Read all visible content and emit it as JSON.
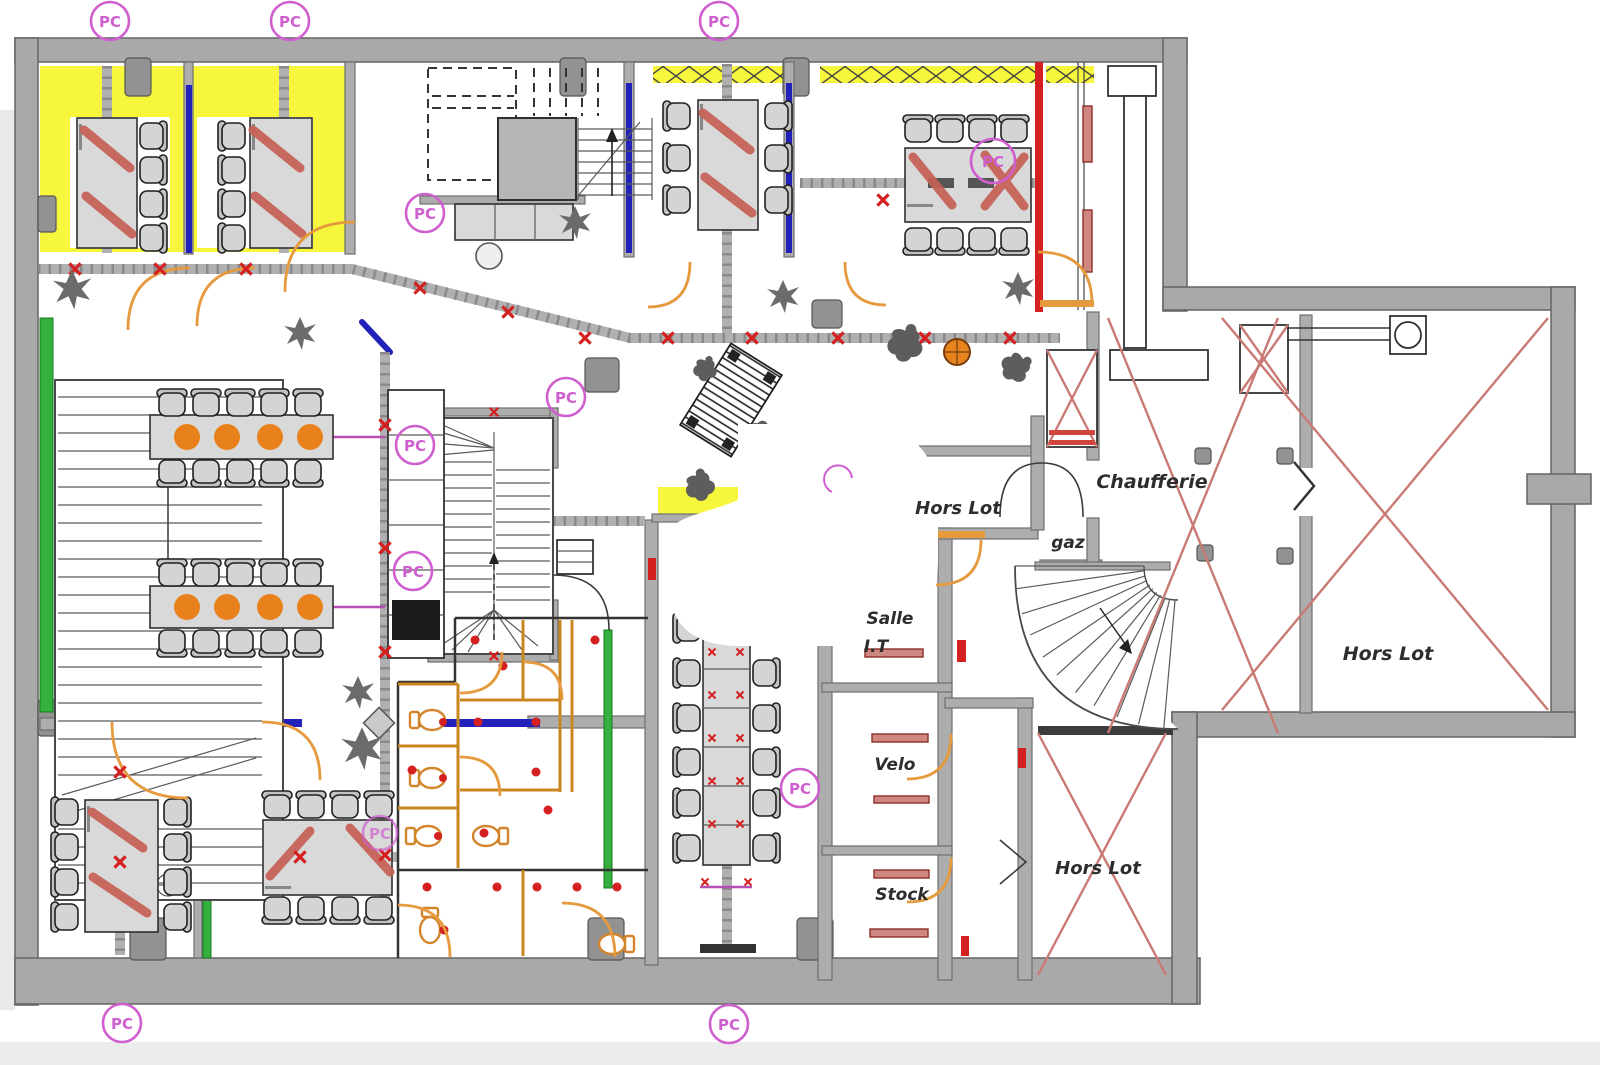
{
  "drawing": {
    "type": "architectural-floor-plan",
    "pc_marker_label": "PC",
    "room_labels": {
      "chaufferie": "Chaufferie",
      "gaz": "gaz",
      "hors_lot_lobby": "Hors Lot",
      "hors_lot_right_wing": "Hors Lot",
      "hors_lot_lower": "Hors Lot",
      "salle_it_line1": "Salle",
      "salle_it_line2": "I.T",
      "velo": "Velo",
      "stock": "Stock"
    },
    "colors": {
      "wall": "#a9a9a9",
      "wall_outline": "#646464",
      "highlight_yellow": "#f6f63c",
      "accent_red": "#d42020",
      "cross_red": "#c65f54",
      "room_x_red": "#c97a74",
      "door_orange": "#e69a3e",
      "accent_blue": "#2222bb",
      "accent_green": "#33b13c",
      "pc_magenta": "#cf5fcf",
      "furniture_gray": "#d9d9d9",
      "furniture_outline": "#2f2f2f",
      "seat_orange": "#e8811c",
      "bar_rose": "#cf8781",
      "rail_gray": "#b0b0b0",
      "stair_line": "#5a5a5a",
      "plant_gray": "#6b6b6b",
      "label_ink": "#2d2d2d"
    }
  }
}
